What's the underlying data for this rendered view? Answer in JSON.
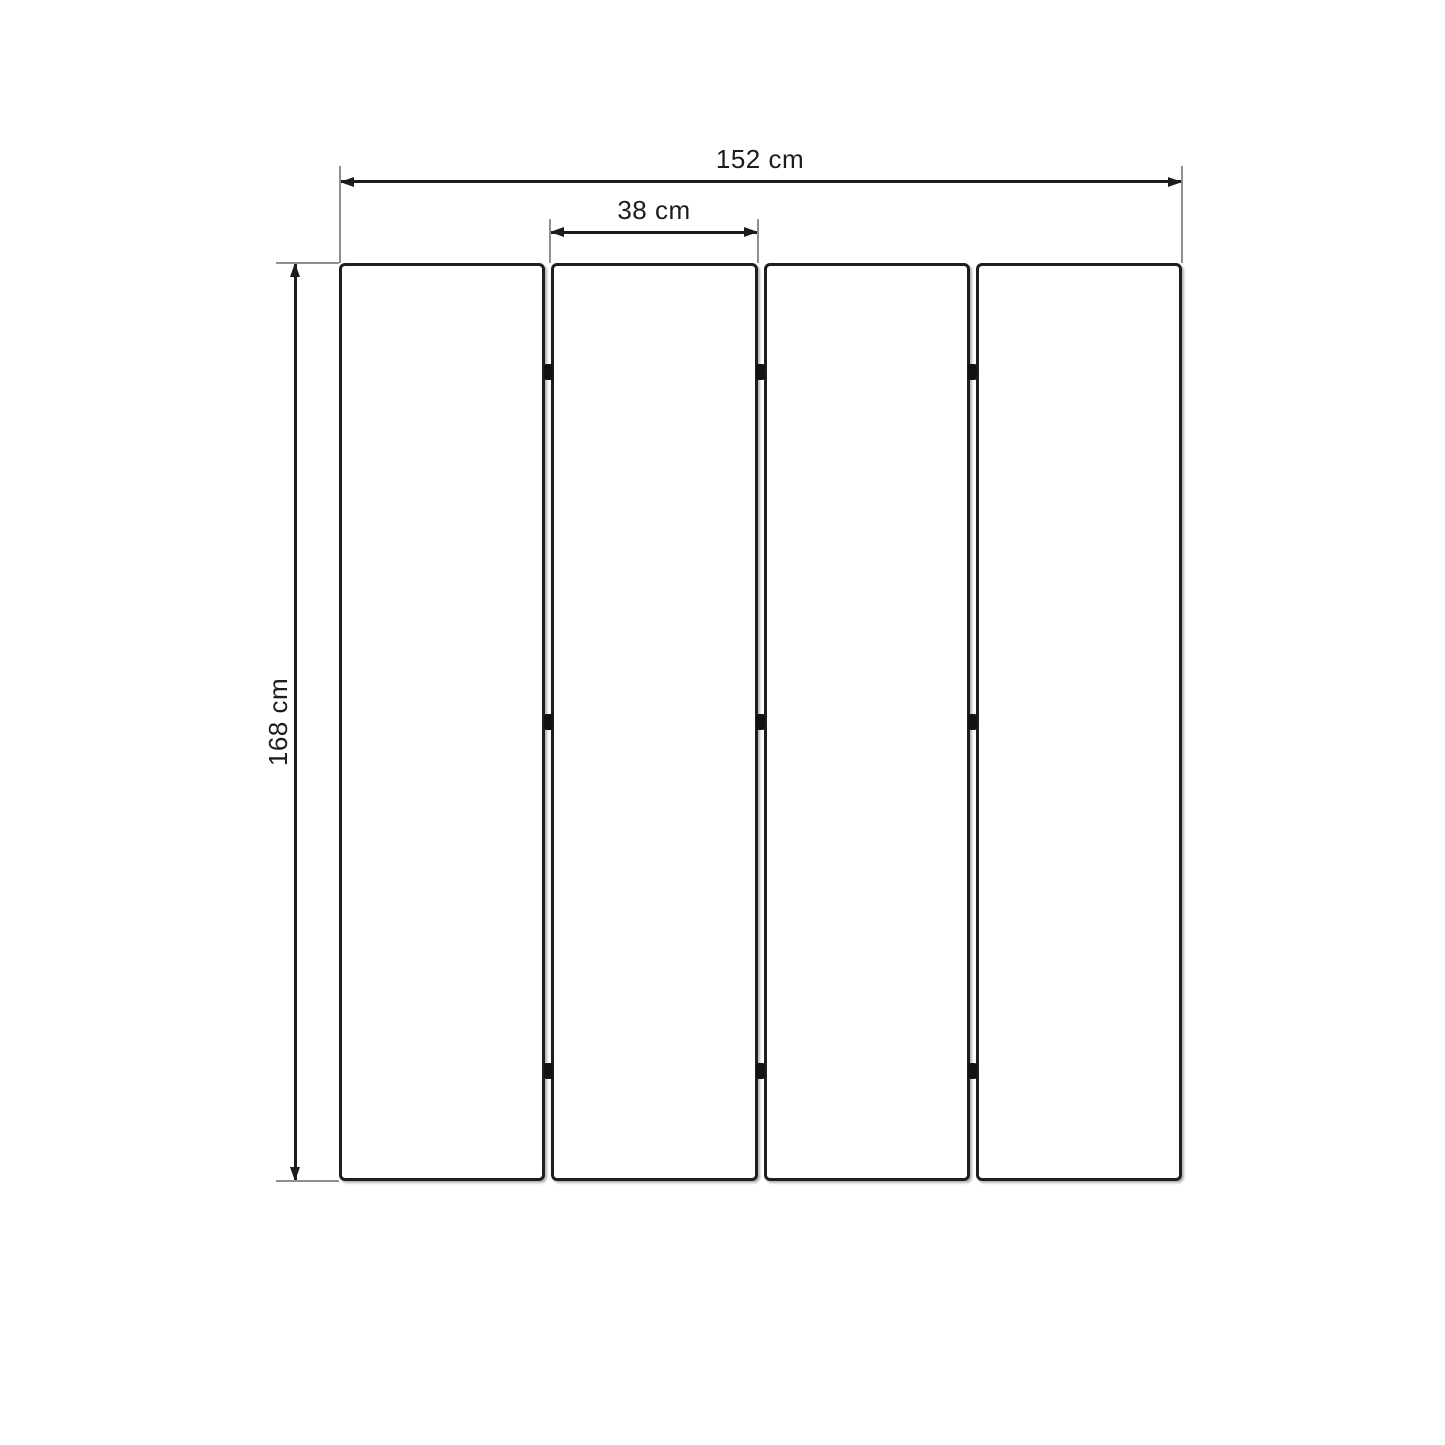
{
  "diagram": {
    "dimension_labels": {
      "total_width": "152 cm",
      "panel_width": "38 cm",
      "height": "168 cm"
    },
    "panels": {
      "count": 4,
      "joints": 3,
      "hinge_rows_per_joint": 3
    },
    "colors": {
      "background": "#ffffff",
      "panel_outline": "#1e1e1e",
      "dimension_line": "#1c1c1c",
      "extension_line": "#8f8f8f",
      "hinge": "#121212"
    }
  }
}
